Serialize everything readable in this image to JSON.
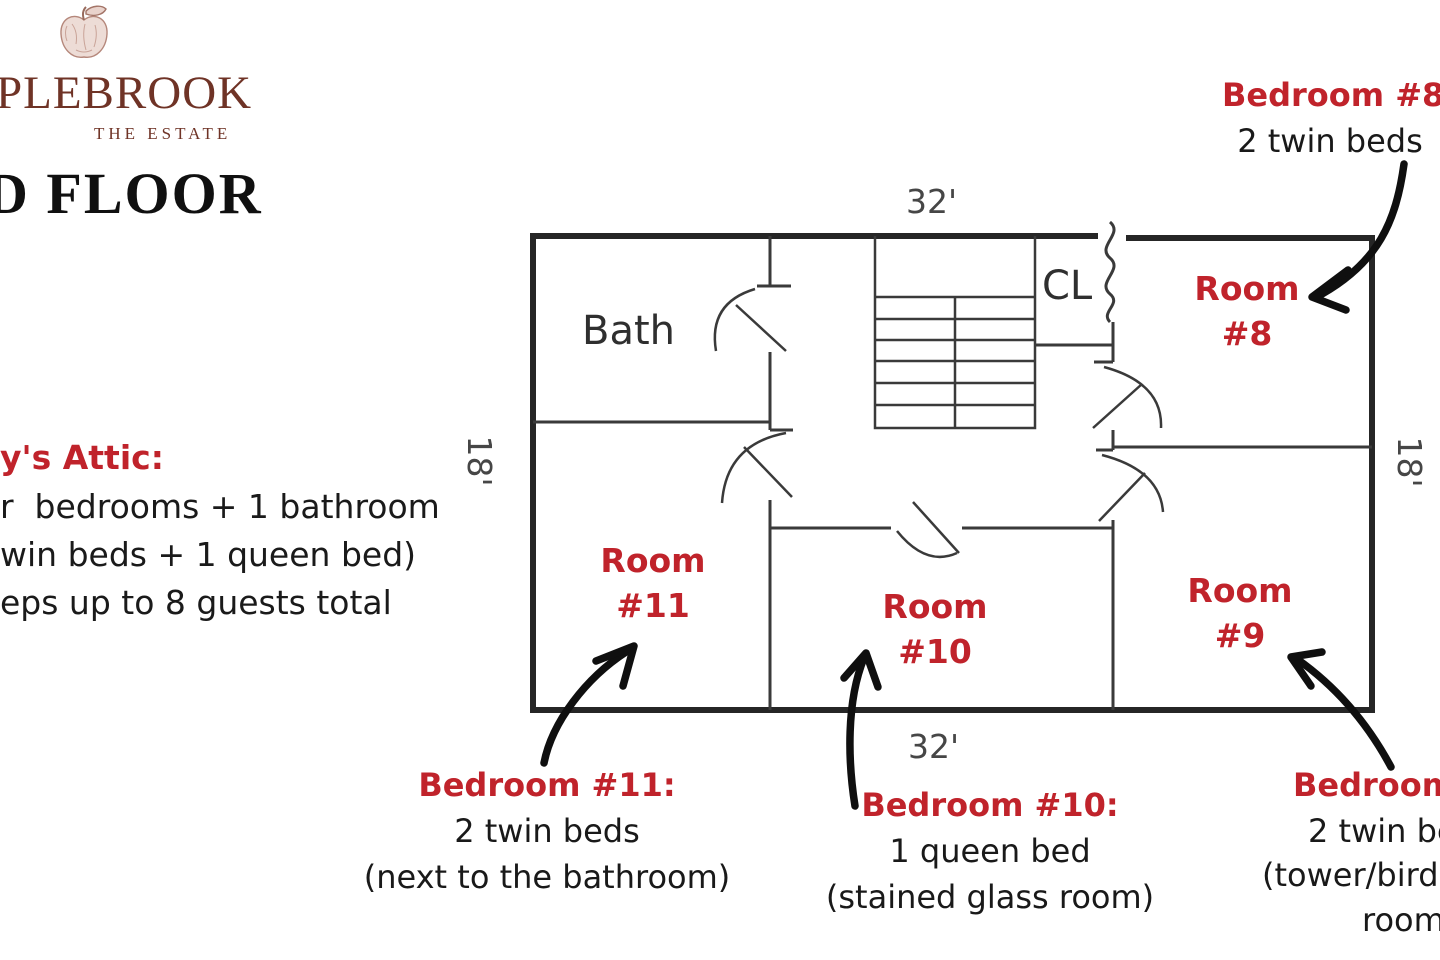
{
  "colors": {
    "accent_red": "#c0232b",
    "text_black": "#1a1a1a",
    "logo_brown": "#6f3326",
    "plan_line": "#2b2b2b"
  },
  "logo": {
    "wordmark": "PLEBROOK",
    "tagline": "THE ESTATE",
    "icon": "apple-sketch-icon"
  },
  "page_title": "D FLOOR",
  "attic_note": {
    "heading": "y's Attic:",
    "line1": "r  bedrooms + 1 bathroom",
    "line2": "win beds + 1 queen bed)",
    "line3": "eps up to 8 guests total"
  },
  "floor_plan": {
    "bath_label": "Bath",
    "closet_label": "CL",
    "dimensions": {
      "top": "32'",
      "bottom": "32'",
      "left": "18'",
      "right": "18'"
    },
    "rooms": {
      "r8": {
        "line1": "Room",
        "line2": "#8"
      },
      "r9": {
        "line1": "Room",
        "line2": "#9"
      },
      "r10": {
        "line1": "Room",
        "line2": "#10"
      },
      "r11": {
        "line1": "Room",
        "line2": "#11"
      }
    }
  },
  "annotations": {
    "bedroom8": {
      "heading": "Bedroom #8:",
      "line1": "2 twin beds"
    },
    "bedroom11": {
      "heading": "Bedroom #11:",
      "line1": "2 twin beds",
      "line2": "(next to the bathroom)"
    },
    "bedroom10": {
      "heading": "Bedroom #10:",
      "line1": "1 queen bed",
      "line2": "(stained glass room)"
    },
    "bedroom9": {
      "heading": "Bedroom",
      "line1": "2 twin be",
      "line2": "(tower/bird",
      "line3": "room"
    }
  }
}
